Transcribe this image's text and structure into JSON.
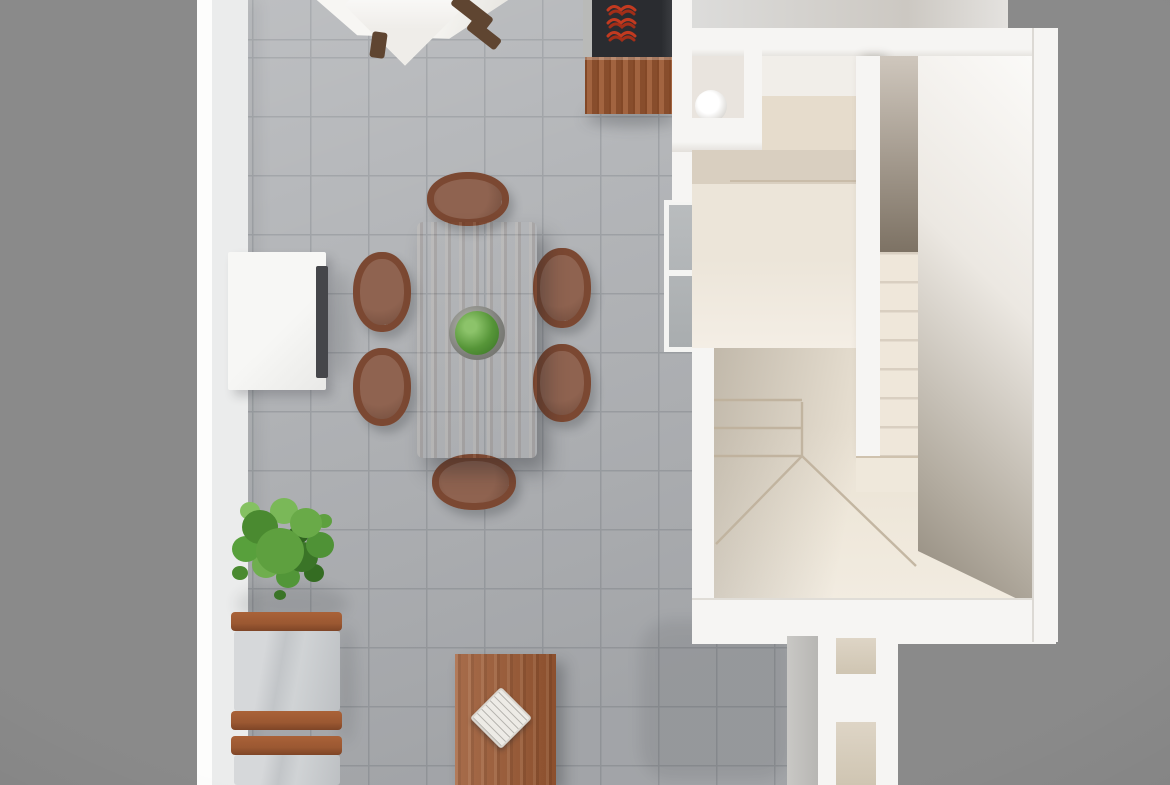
{
  "meta": {
    "title": "3D floor plan - top-down architectural render",
    "view": "top-down isometric",
    "visible_text": "none"
  },
  "palette": {
    "bg": "#8a8a8a",
    "floor": "#b4b6b9",
    "floor_line": "#9fa2a6",
    "wall": "#f6f5f3",
    "wall_face": "#ebecec",
    "cream": "#efe8dc",
    "cream_dark": "#d9cfc0",
    "wood": "#9b5832",
    "wood_dark": "#5f4531",
    "table_wood": "#a8643c",
    "chair_frame": "#7b4832",
    "chair_seat": "#8f6350",
    "sofa": "#caccce",
    "plant": "#5ea03f",
    "plant_dark": "#3a7427",
    "stove": "#2a2c30",
    "burner": "#c23a20",
    "glass": "#b9bcbe",
    "sideboard_tv": "#45464a"
  },
  "rooms": [
    {
      "name": "living-dining-area",
      "floor": "gray ceramic tile"
    },
    {
      "name": "kitchen-corner",
      "floor": "gray ceramic tile"
    },
    {
      "name": "bathroom",
      "fixtures": [
        "toilet"
      ]
    },
    {
      "name": "hallway-closet",
      "floor": "cream"
    },
    {
      "name": "staircase",
      "features": [
        "straight flight",
        "winder steps",
        "landing"
      ]
    }
  ],
  "furniture": [
    {
      "name": "patio-table",
      "material": "white top, wood legs"
    },
    {
      "name": "kitchen-stove",
      "detail": "black cooktop with red burner coils"
    },
    {
      "name": "kitchen-cabinet",
      "material": "wood"
    },
    {
      "name": "dining-table",
      "material": "wood",
      "seats": 6,
      "centerpiece": "green plant in pot"
    },
    {
      "name": "dining-chair",
      "count": 6,
      "material": "wood frame, brown cushion"
    },
    {
      "name": "sideboard",
      "detail": "white cabinet with dark edge (TV)"
    },
    {
      "name": "potted-plant",
      "detail": "large green bush"
    },
    {
      "name": "armchair",
      "count": 2,
      "material": "wood arms, light gray cushions"
    },
    {
      "name": "coffee-table",
      "material": "wood",
      "on_top": "white book/tray rotated 45deg"
    }
  ]
}
